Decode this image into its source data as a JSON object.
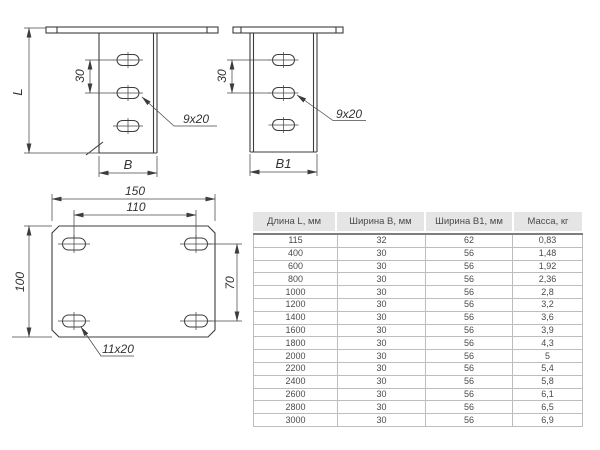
{
  "drawings": {
    "bracket_front": {
      "length_label": "L",
      "hole_spacing": "30",
      "width_label": "B",
      "slot_callout": "9x20"
    },
    "bracket_side": {
      "hole_spacing": "30",
      "width_label": "B1",
      "slot_callout": "9x20"
    },
    "base_plate": {
      "overall_width": "150",
      "hole_spacing_horizontal": "110",
      "overall_height": "100",
      "hole_spacing_vertical": "70",
      "slot_callout": "11x20"
    }
  },
  "table": {
    "headers": [
      "Длина L, мм",
      "Ширина B, мм",
      "Ширина B1, мм",
      "Масса, кг"
    ],
    "rows": [
      [
        "115",
        "32",
        "62",
        "0,83"
      ],
      [
        "400",
        "30",
        "56",
        "1,48"
      ],
      [
        "600",
        "30",
        "56",
        "1,92"
      ],
      [
        "800",
        "30",
        "56",
        "2,36"
      ],
      [
        "1000",
        "30",
        "56",
        "2,8"
      ],
      [
        "1200",
        "30",
        "56",
        "3,2"
      ],
      [
        "1400",
        "30",
        "56",
        "3,6"
      ],
      [
        "1600",
        "30",
        "56",
        "3,9"
      ],
      [
        "1800",
        "30",
        "56",
        "4,3"
      ],
      [
        "2000",
        "30",
        "56",
        "5"
      ],
      [
        "2200",
        "30",
        "56",
        "5,4"
      ],
      [
        "2400",
        "30",
        "56",
        "5,8"
      ],
      [
        "2600",
        "30",
        "56",
        "6,1"
      ],
      [
        "2800",
        "30",
        "56",
        "6,5"
      ],
      [
        "3000",
        "30",
        "56",
        "6,9"
      ]
    ]
  },
  "colors": {
    "line": "#3c3c3c",
    "table_header_bg": "#e5e5e5",
    "table_border": "#9a9a9a",
    "text": "#444444"
  }
}
